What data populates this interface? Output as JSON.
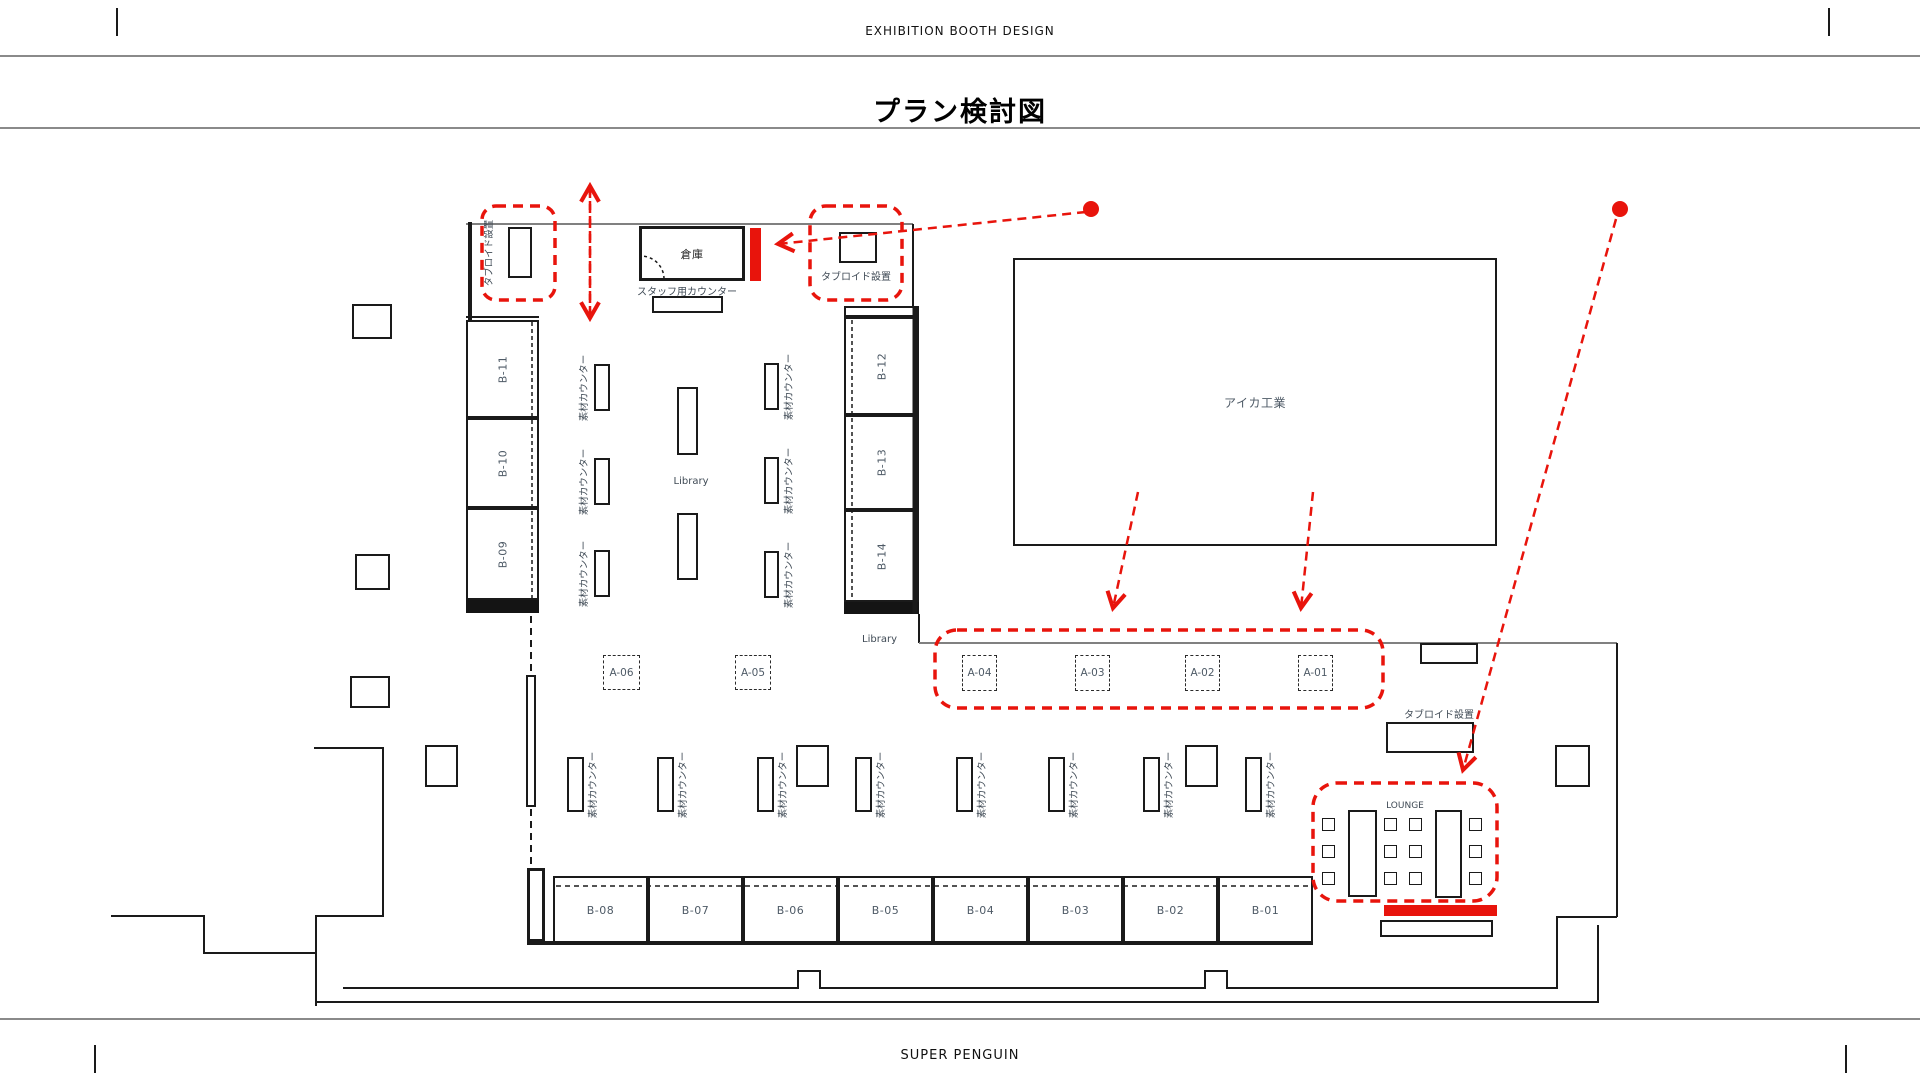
{
  "header": {
    "top_label": "EXHIBITION BOOTH DESIGN",
    "title": "プラン検討図"
  },
  "footer": {
    "brand": "SUPER PENGUIN"
  },
  "plan": {
    "labels": {
      "storage": "倉庫",
      "staff_counter": "スタッフ用カウンター",
      "tabloid": "タブロイド設置",
      "material_counter": "素材カウンター",
      "library": "Library",
      "aica": "アイカ工業",
      "lounge": "LOUNGE"
    },
    "booths": {
      "left_column": [
        "B-11",
        "B-10",
        "B-09"
      ],
      "right_column": [
        "B-12",
        "B-13",
        "B-14"
      ],
      "bottom_row": [
        "B-08",
        "B-07",
        "B-06",
        "B-05",
        "B-04",
        "B-03",
        "B-02",
        "B-01"
      ],
      "a_row": [
        "A-04",
        "A-03",
        "A-02",
        "A-01"
      ],
      "a_mid": [
        "A-06",
        "A-05"
      ]
    },
    "colors": {
      "accent_red": "#e8140c",
      "line_black": "#1a1a1a",
      "wall_gray": "#808080",
      "label_gray": "#4e5a66"
    }
  }
}
